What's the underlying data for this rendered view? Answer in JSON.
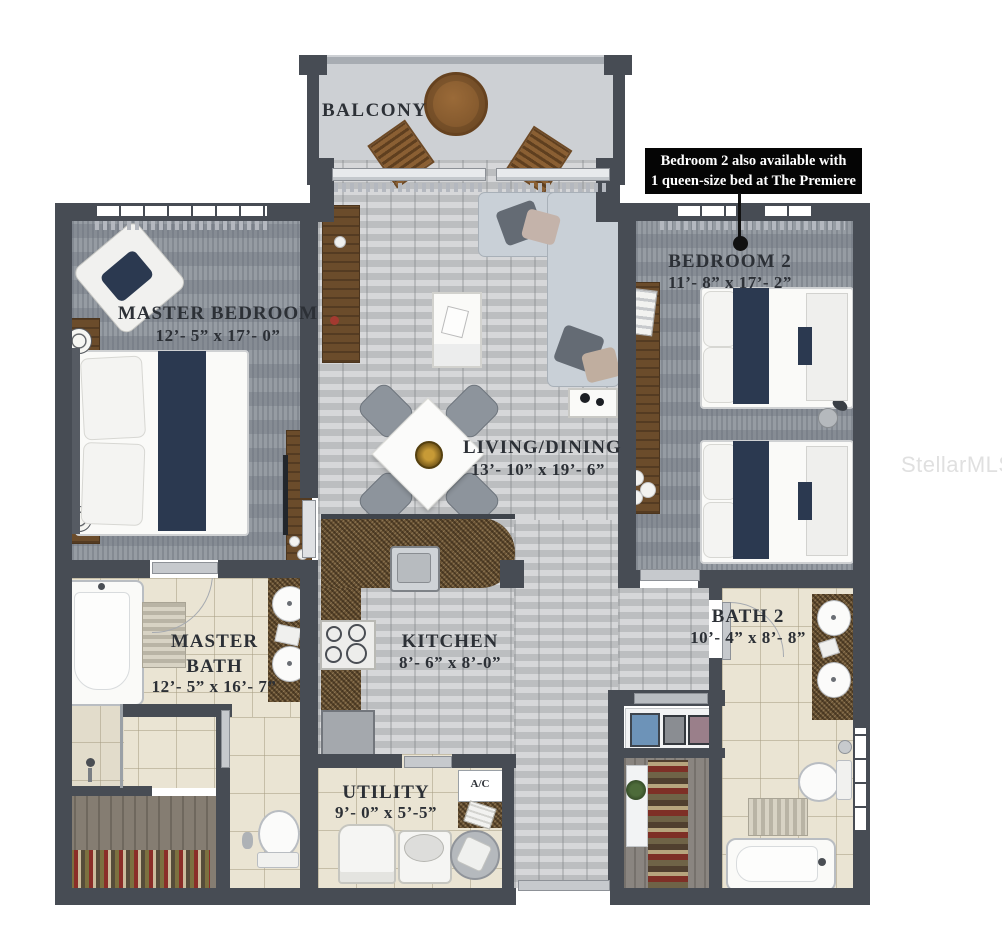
{
  "annotation": {
    "line1": "Bedroom 2 also available with",
    "line2": "1 queen-size bed at The Premiere"
  },
  "watermark": "StellarMLS",
  "rooms": {
    "balcony": {
      "name": "BALCONY"
    },
    "master_bedroom": {
      "name": "MASTER BEDROOM",
      "dims": "12’- 5” x 17’- 0”"
    },
    "bedroom_2": {
      "name": "BEDROOM 2",
      "dims": "11’- 8” x 17’- 2”"
    },
    "living_dining": {
      "name": "LIVING/DINING",
      "dims": "13’- 10” x 19’- 6”"
    },
    "kitchen": {
      "name": "KITCHEN",
      "dims": "8’- 6” x 8’-0”"
    },
    "master_bath": {
      "name": "MASTER BATH",
      "dims": "12’- 5” x 16’- 7”"
    },
    "bath_2": {
      "name": "BATH 2",
      "dims": "10’- 4” x 8’- 8”"
    },
    "utility": {
      "name": "UTILITY",
      "dims": "9’- 0” x 5’-5”"
    },
    "ac_closet": {
      "name": "A/C"
    }
  },
  "colors": {
    "wall": "#474c54",
    "carpet": "#8e949c",
    "wood_floor": "#c6c8ca",
    "tile": "#eae4d3",
    "counter_granite": "#6a5334",
    "accent_navy": "#2b3950",
    "annotation_bg": "#050505",
    "annotation_text": "#ffffff"
  }
}
